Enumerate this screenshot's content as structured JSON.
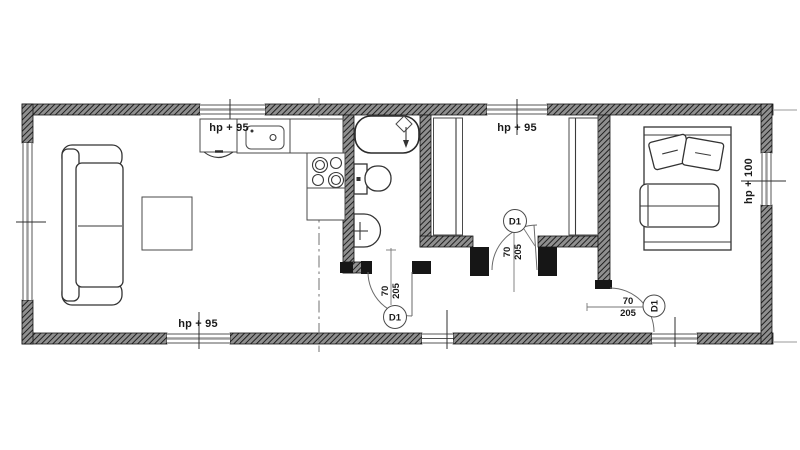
{
  "floor_plan": {
    "window_labels": [
      "hp + 95",
      "hp + 95",
      "hp + 95",
      "hp + 100"
    ],
    "doors": [
      {
        "tag": "D1",
        "width": "70",
        "height": "205"
      },
      {
        "tag": "D1",
        "width": "70",
        "height": "205"
      },
      {
        "tag": "D1",
        "width": "70",
        "height": "205"
      }
    ],
    "colors": {
      "background": "#ffffff",
      "linework": "#333333",
      "wall": "#2f2f2f"
    }
  }
}
